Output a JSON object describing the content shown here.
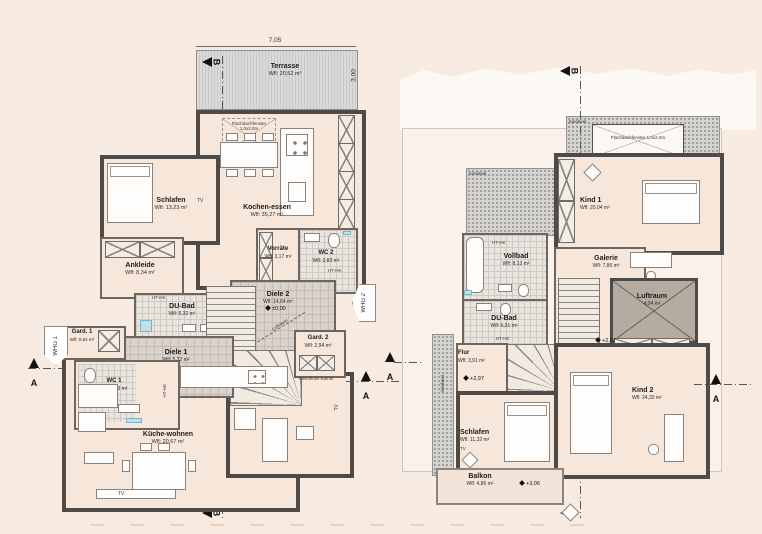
{
  "left": {
    "dims": {
      "width": "7,05",
      "depth": "3,00"
    },
    "markers": {
      "a": "A",
      "b": "B",
      "whg1": "WHG 1",
      "whg2": "WHG 2",
      "level_ground": "±0,00",
      "luftraum": "Luftraum",
      "anschluss_kamin": "Anschluss Kamin",
      "tv": "TV",
      "ht_hk": "HT-HK",
      "roof_window": "Flachdachfenster",
      "roof_window_size": "1,0x2,0m"
    },
    "rooms": {
      "terrasse": {
        "label": "Terrasse",
        "area": "Wfl: 20,52 m²"
      },
      "kochen_essen": {
        "label": "Kochen-essen",
        "area": "Wfl: 35,27 m²"
      },
      "schlafen": {
        "label": "Schlafen",
        "area": "Wfl: 13,23 m²"
      },
      "ankleide": {
        "label": "Ankleide",
        "area": "Wfl: 8,34 m²"
      },
      "vorraete": {
        "label": "Vorräte",
        "area": "Wfl: 3,17 m²"
      },
      "wc2": {
        "label": "WC 2",
        "area": "Wfl: 2,83 m²"
      },
      "du_bad": {
        "label": "DU-Bad",
        "area": "Wfl: 6,32 m²"
      },
      "diele2": {
        "label": "Diele 2",
        "area": "Wfl: 14,64 m²"
      },
      "gard1": {
        "label": "Gard. 1",
        "area": "Wfl: 0,84 m²"
      },
      "diele1": {
        "label": "Diele 1",
        "area": "Wfl: 5,22 m²"
      },
      "wc1": {
        "label": "WC 1",
        "area": "Wfl: 2,53 m²"
      },
      "gard2": {
        "label": "Gard. 2",
        "area": "Wfl: 2,94 m²"
      },
      "wohnen": {
        "label": "Wohnen",
        "area": "Wfl: 19,88 m²"
      },
      "kueche_wohnen": {
        "label": "Küche-wohnen",
        "area": "Wfl: 20,67 m²"
      }
    }
  },
  "right": {
    "markers": {
      "a": "A",
      "b": "B",
      "kiesbeet": "Kiesbeet",
      "level_upper": "+2,97",
      "level_balkon": "+3,06",
      "tv": "TV",
      "ht_hk": "HT-HK",
      "roof_window": "Flachdachfenster",
      "roof_window_size": "1,0x2,0m"
    },
    "rooms": {
      "kind1": {
        "label": "Kind 1",
        "area": "Wfl: 20,04 m²"
      },
      "vollbad": {
        "label": "Vollbad",
        "area": "Wfl: 8,13 m²"
      },
      "galerie": {
        "label": "Galerie",
        "area": "Wfl: 7,86 m²"
      },
      "luftraum": {
        "label": "Luftraum",
        "area": "4,04 m²"
      },
      "du_bad": {
        "label": "DU-Bad",
        "area": "Wfl: 6,31 m²"
      },
      "flur": {
        "label": "Flur",
        "area": "Wfl: 3,91 m²"
      },
      "schlafen": {
        "label": "Schlafen",
        "area": "Wfl: 11,32 m²"
      },
      "kind2": {
        "label": "Kind 2",
        "area": "Wfl: 24,33 m²"
      },
      "balkon": {
        "label": "Balkon",
        "area": "Wfl: 4,86 m²"
      }
    }
  }
}
